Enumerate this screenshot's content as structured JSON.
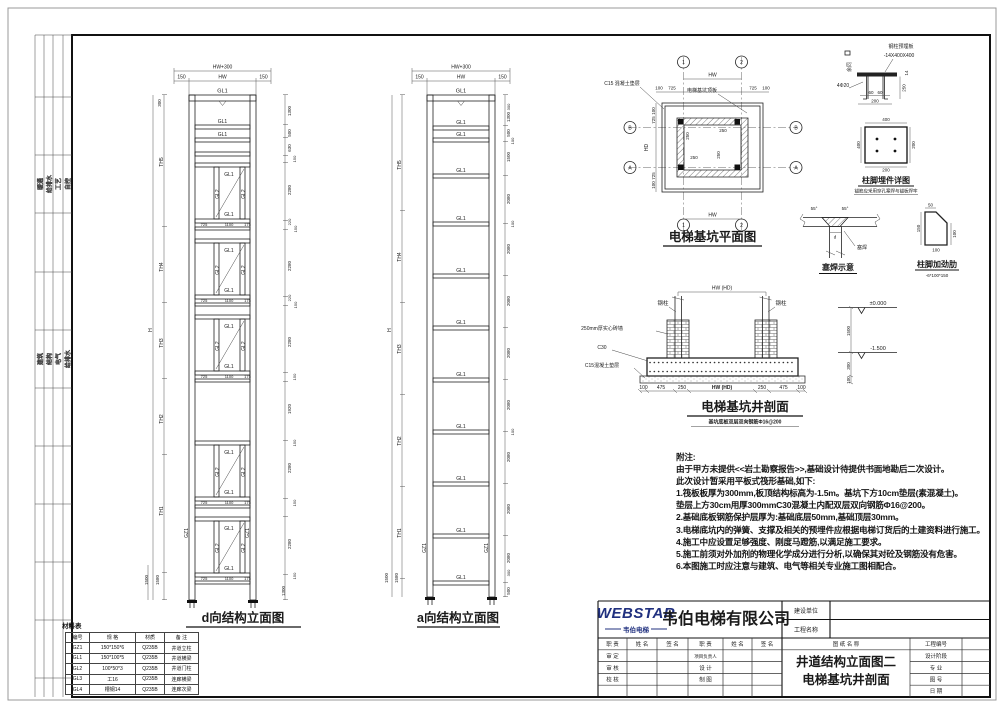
{
  "strip": {
    "g1": [
      "暖通",
      "给排水",
      "工艺",
      "自控"
    ],
    "g2": [
      "建筑",
      "结构",
      "电气",
      "给排水"
    ]
  },
  "labels": {
    "GL1": "GL1",
    "GL2": "GL2",
    "GZ1": "GZ1"
  },
  "dims": {
    "150": "150",
    "300": "300",
    "100": "100",
    "725": "725",
    "1100": "1100",
    "175": "175",
    "1300": "1300",
    "500": "500",
    "630": "630",
    "2280": "2280",
    "220": "220",
    "1920": "1920",
    "2080": "2080",
    "1500": "1500",
    "1580": "1580",
    "250": "250",
    "475": "475",
    "400": "400",
    "200": "200",
    "60": "60",
    "14": "14",
    "50": "50",
    "hw": "HW",
    "hw300": "HW+300",
    "hd": "HD",
    "hwhd": "HW (HD)",
    "h": "H",
    "th1": "TH1",
    "th2": "TH2",
    "th3": "TH3",
    "th4": "TH4",
    "th5": "TH5"
  },
  "grid": {
    "g1": "1",
    "g2": "2",
    "ga": "A",
    "gb": "B"
  },
  "elev_d": {
    "title": "d向结构立面图"
  },
  "elev_a": {
    "title": "a向结构立面图"
  },
  "plan": {
    "title": "电梯基坑平面图",
    "cushion_note": "C15 混凝土垫层",
    "slab_note": "电梯基坑顶板"
  },
  "embed": {
    "plate_note": "钢柱预埋板",
    "plate_size": "-14X400X400",
    "rest_same": "余同",
    "anchors": "4Φ20",
    "title": "柱脚埋件详图",
    "subtitle": "锚筋应采用穿孔塞焊与锚板焊牢"
  },
  "weld": {
    "title": "塞焊示意",
    "label": "塞焊",
    "angle": "55°",
    "d": "d"
  },
  "stiffener": {
    "title": "柱脚加劲肋",
    "subtitle": "-6*100*150"
  },
  "section": {
    "title": "电梯基坑井剖面",
    "subtitle": "基坑底板双层双向钢筋Φ16@200",
    "steel_col": "钢柱",
    "brick_note": "250mm厚实心砖墙",
    "c30": "C30",
    "cushion_note": "C15混凝土垫层",
    "level0": "±0.000",
    "level1": "-1.500"
  },
  "notes": {
    "heading": "附注:",
    "lines": [
      "由于甲方未提供<<岩土勘察报告>>,基础设计待提供书面地勘后二次设计。",
      "此次设计暂采用平板式筏形基础,如下:",
      "1.筏板板厚为300mm,板顶结构标高为-1.5m。基坑下方10cm垫层(素混凝土)。",
      "垫层上方30cm用厚300mmC30混凝土内配双层双向钢筋Φ16@200。",
      "2.基础底板钢筋保护层厚为:基础底层50mm,基础顶层30mm。",
      "3.电梯底坑内的弹簧、支撑及相关的预埋件应根据电梯订货后的土建资料进行施工。",
      "4.施工中应设置足够强度、刚度马蹬筋,以满足施工要求。",
      "5.施工前须对外加剂的物理化学成分进行分析,以确保其对砼及钢筋没有危害。",
      "6.本图施工时应注意与建筑、电气等相关专业施工图相配合。"
    ]
  },
  "material_table": {
    "title": "材料表",
    "headers": [
      "编号",
      "规 格",
      "材质",
      "备 注"
    ],
    "rows": [
      [
        "GZ1",
        "150*150*6",
        "Q235B",
        "井道立柱"
      ],
      [
        "GL1",
        "150*100*5",
        "Q235B",
        "井道横梁"
      ],
      [
        "GL2",
        "100*50*3",
        "Q235B",
        "井道门柱"
      ],
      [
        "GL3",
        "工16",
        "Q235B",
        "连廊横梁"
      ],
      [
        "GL4",
        "槽钢14",
        "Q235B",
        "连廊次梁"
      ]
    ]
  },
  "titleblock": {
    "logo": "WEBSTAR",
    "logo_sub": "韦伯电梯",
    "company": "韦伯电梯有限公司",
    "owner_label": "建设单位",
    "project_label": "工程名称",
    "col_role": "职 责",
    "col_name": "姓 名",
    "col_sign": "签 名",
    "drawing_name_label": "图 纸 名 称",
    "row_shending": "审 定",
    "row_shenhe": "审 核",
    "row_jiaohe": "校 核",
    "row_pm": "项目负责人",
    "row_sheji": "设 计",
    "row_zhitu": "制 图",
    "drawing_name_1": "井道结构立面图二",
    "drawing_name_2": "电梯基坑井剖面",
    "right_labels": [
      "工程编号",
      "设计阶段",
      "专 业",
      "图 号",
      "日 期"
    ]
  }
}
